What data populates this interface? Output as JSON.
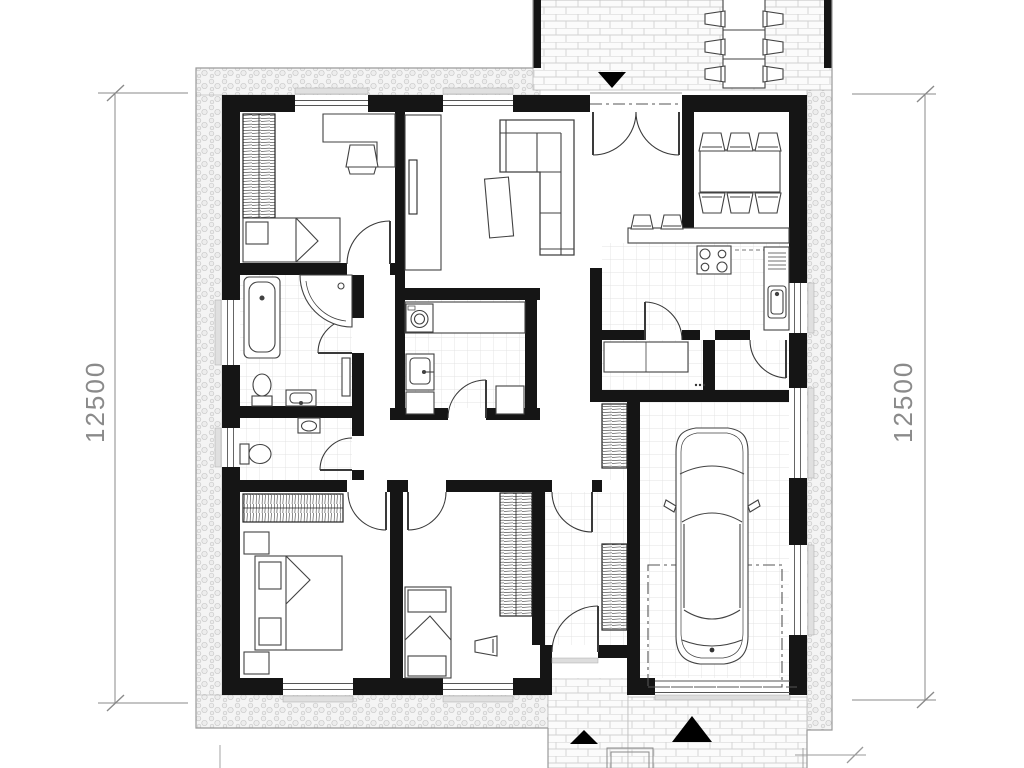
{
  "page": {
    "background": "#ffffff",
    "type": "architectural-floor-plan"
  },
  "dimensions": {
    "left": {
      "label": "12500"
    },
    "right": {
      "label": "12500"
    }
  },
  "palette": {
    "wall": "#151515",
    "furniture_line": "#424242",
    "dimension_line": "#8a8a8a",
    "tile_line": "#e3e3e3",
    "gravel_dot": "#c9c9c9",
    "brick_line": "#d2d2d2",
    "marker_black": "#000000",
    "paper": "#ffffff"
  },
  "legend": {
    "areas": [
      "terrace",
      "living-room",
      "dining-area",
      "kitchen",
      "pantry",
      "mudroom",
      "bedroom-1",
      "bathroom",
      "wc",
      "utility-room",
      "hallway",
      "master-bedroom",
      "bedroom-2",
      "entry-hall",
      "garage",
      "porch",
      "driveway",
      "gravel-apron"
    ],
    "icons": [
      "garden-table-icon",
      "garden-chair-icon",
      "entrance-marker-icon",
      "wardrobe-icon",
      "desk-icon",
      "chair-icon",
      "single-bed-icon",
      "double-bed-icon",
      "nightstand-icon",
      "corner-sofa-icon",
      "coffee-table-icon",
      "tv-cabinet-icon",
      "dining-table-icon",
      "dining-chair-icon",
      "bar-stool-icon",
      "kitchen-island-icon",
      "stove-icon",
      "kitchen-sink-icon",
      "bathtub-icon",
      "shower-icon",
      "toilet-icon",
      "washbasin-icon",
      "radiator-icon",
      "washing-machine-icon",
      "utility-sink-icon",
      "laundry-basket-icon",
      "car-icon",
      "doormat-icon",
      "window-icon",
      "door-icon"
    ]
  }
}
